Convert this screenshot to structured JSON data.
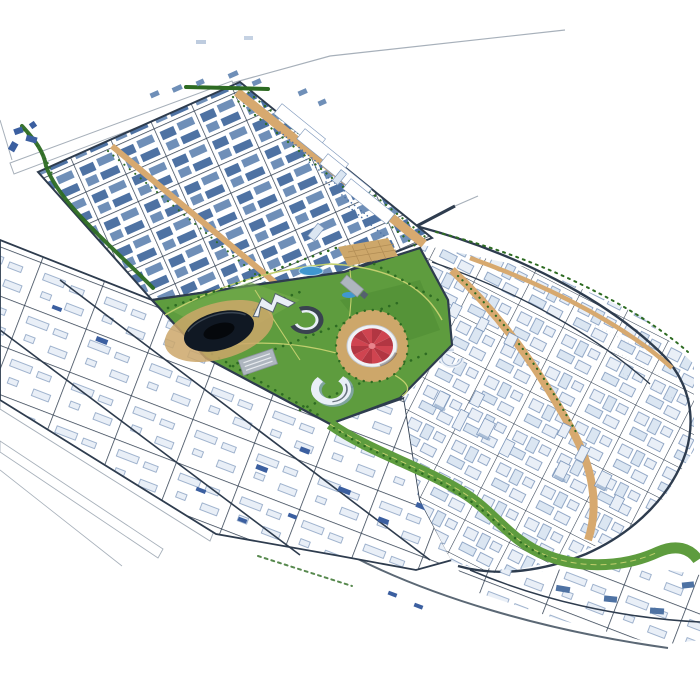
{
  "scene": {
    "kind": "3d-city-masterplan-rendering",
    "view": "aerial-axonometric",
    "background": "plain white studio backdrop",
    "text_visible": "none"
  },
  "colors": {
    "background": "#ffffff",
    "road_dark": "#2e3c4e",
    "road_outline": "#a7b0ba",
    "boulevard_tan": "#d7a96f",
    "plaza_tan": "#cda76a",
    "plaza_grid": "#b08c54",
    "park_green": "#5e9c3e",
    "park_green_light": "#77ae4e",
    "park_green_dark": "#4f8c33",
    "tree_green": "#2d6b22",
    "path_yellow": "#c2cf6e",
    "water_blue": "#3f97cf",
    "building_blue": "#4e72a3",
    "building_blue_light": "#6f8fb8",
    "building_blue_dark": "#3b5fa0",
    "building_white": "#e9eff7",
    "building_white_dim": "#dbe6f2",
    "building_outline": "#7d97bb",
    "building_shadow": "#8fa9c9",
    "stadium_dark": "#101823",
    "stadium_hole": "#05080c",
    "tent_red": "#cf4450",
    "tent_red_dark": "#b23642",
    "tent_rim": "#f0f2f5",
    "tent_center": "#e8848c",
    "hall_gray": "#aeb6bf",
    "hall_gray_dark": "#8a929c"
  },
  "features": [
    {
      "id": "upper-residential-district",
      "type": "district",
      "texture": "dense steel-blue mid-rise grid with tan boulevards"
    },
    {
      "id": "central-park",
      "type": "park",
      "texture": "lawns, winding paths, tree rows, ponds, plazas"
    },
    {
      "id": "stadium",
      "type": "landmark",
      "shape": "dark oval bowl on tan plaza"
    },
    {
      "id": "circus-tent-building",
      "type": "landmark",
      "shape": "red radial segmented dome on white ring base"
    },
    {
      "id": "crescent-building-dark",
      "type": "landmark",
      "shape": "C-shaped annular block"
    },
    {
      "id": "crescent-building-south",
      "type": "landmark",
      "shape": "C-shaped annular block"
    },
    {
      "id": "crescent-building-east",
      "type": "landmark",
      "shape": "small C-shaped block"
    },
    {
      "id": "exhibition-hall",
      "type": "landmark",
      "shape": "gray slab hall"
    },
    {
      "id": "gabled-complex",
      "type": "landmark",
      "shape": "white angular A-shaped complex"
    },
    {
      "id": "pond-north",
      "type": "water"
    },
    {
      "id": "pond-east",
      "type": "water"
    },
    {
      "id": "central-plaza",
      "type": "plaza",
      "texture": "tan square with grid paths"
    },
    {
      "id": "right-highrise-district",
      "type": "district",
      "texture": "white towers along curving tan boulevard"
    },
    {
      "id": "lower-industrial-district",
      "type": "district",
      "texture": "sparse low white sheds in large blocks"
    },
    {
      "id": "southeast-blocks",
      "type": "district",
      "texture": "curved rows of blue-white blocks"
    },
    {
      "id": "linear-park-band",
      "type": "park",
      "shape": "sinuous green ribbon with paths"
    },
    {
      "id": "ring-road",
      "type": "road"
    },
    {
      "id": "tree-lined-avenue",
      "type": "road"
    },
    {
      "id": "perimeter-outline-roads",
      "type": "road"
    },
    {
      "id": "blue-landmark-cluster",
      "type": "landmark"
    }
  ]
}
